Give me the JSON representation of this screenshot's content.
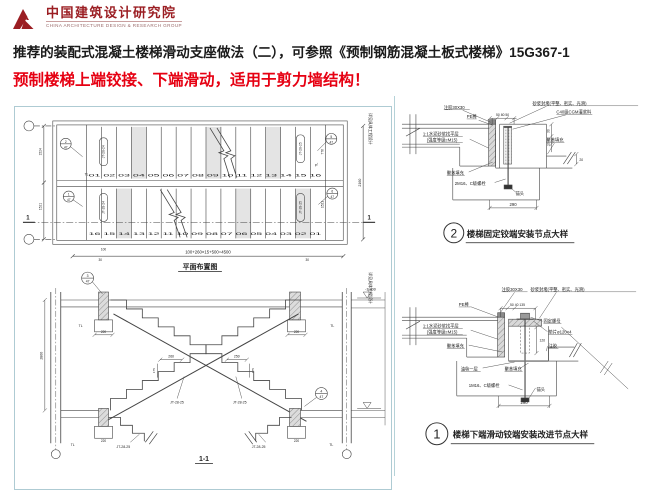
{
  "logo": {
    "cn": "中国建筑设计研究院",
    "en": "CHINA ARCHITECTURE DESIGN & RESEARCH GROUP"
  },
  "title": "推荐的装配式混凝土楼梯滑动支座做法（二），可参照《预制钢筋混凝土板式楼梯》15G367-1",
  "subtitle": "预制楼梯上端铰接、下端滑动，适用于剪力墙结构！",
  "colors": {
    "brand_red": "#9b1e23",
    "alert_red": "#e60012",
    "drawing_line": "#444444",
    "panel_border": "#aecbd3"
  },
  "plan": {
    "title": "平面布置图",
    "top_steps": "01 02 03 04 05 06 07 08 09 10 11 12 13 14 15 16",
    "bottom_steps": "16 15 14 13 12 11 10 09 08 07 06 05 04 03 02 01",
    "code_left_top": "JT-28-24",
    "code_left_bottom": "JT-28-24",
    "code_right_top": "JT-28-25",
    "code_right_bottom": "JT-28-25",
    "bubble_left_top": "2",
    "bubble_left_bottom": "1",
    "bubble_right_top": "5",
    "bubble_right_bottom": "6",
    "bubble_sheet": "47",
    "dim_bottom": "100+260×15+500=4500",
    "dim_100": "100",
    "dim_30": "30",
    "dim_right": "2160",
    "dim_left_top": "1524",
    "dim_left_bottom": "1521",
    "dim_right_inner_top": "776",
    "dim_right_inner_bottom": "1521",
    "beam_label": "TL",
    "side_note": "详见具体工程设计",
    "section_mark": "1"
  },
  "section": {
    "title": "1-1",
    "dim_height": "2800",
    "dim_tread_left": "260",
    "dim_tread_right": "250",
    "dim_beam": "220",
    "dim_riser": "175",
    "flight_code": "JT-28-25",
    "beam_label": "TL",
    "elevation": "-1.800",
    "bubble_top": "3",
    "bubble_right": "4",
    "bubble_sheet": "47"
  },
  "detail2": {
    "num": "2",
    "caption": "楼梯固定铰端安装节点大样",
    "glue": "注胶30X30",
    "pe": "PE棒",
    "leveling1": "1:1水泥砂浆找平层",
    "leveling2": "(强度等级≥M15)",
    "seal": "砂浆封堵(平整、密实、光滑)",
    "grout": "C40级CGM灌浆料",
    "poly_left": "聚苯填充",
    "poly_right": "聚苯填充",
    "bolt": "2M16、C级螺栓",
    "anchor": "锚头",
    "dim_top": "50 80 50",
    "dim_30": "30",
    "dim_10": "10",
    "dim_20": "20",
    "dim_bottom": "290"
  },
  "detail1": {
    "num": "1",
    "caption": "楼梯下端滑动铰端安装改进节点大样",
    "glue": "注胶30X30",
    "seal": "砂浆封堵(平整、密实、光滑)",
    "pe": "PE棒",
    "leveling1": "1:1水泥砂浆找平层",
    "leveling2": "(强度等级≥M15)",
    "poly_left": "聚苯填充",
    "nut": "固定螺母",
    "washer": "垫片ø120×4",
    "dim_120": "120",
    "glue2": "注胶",
    "felt": "油毡一层",
    "poly_mid": "聚苯填充",
    "bolt": "1M16、C级螺栓",
    "anchor": "锚头",
    "dim_top": "50 40 135",
    "dim_bottom": "290"
  }
}
